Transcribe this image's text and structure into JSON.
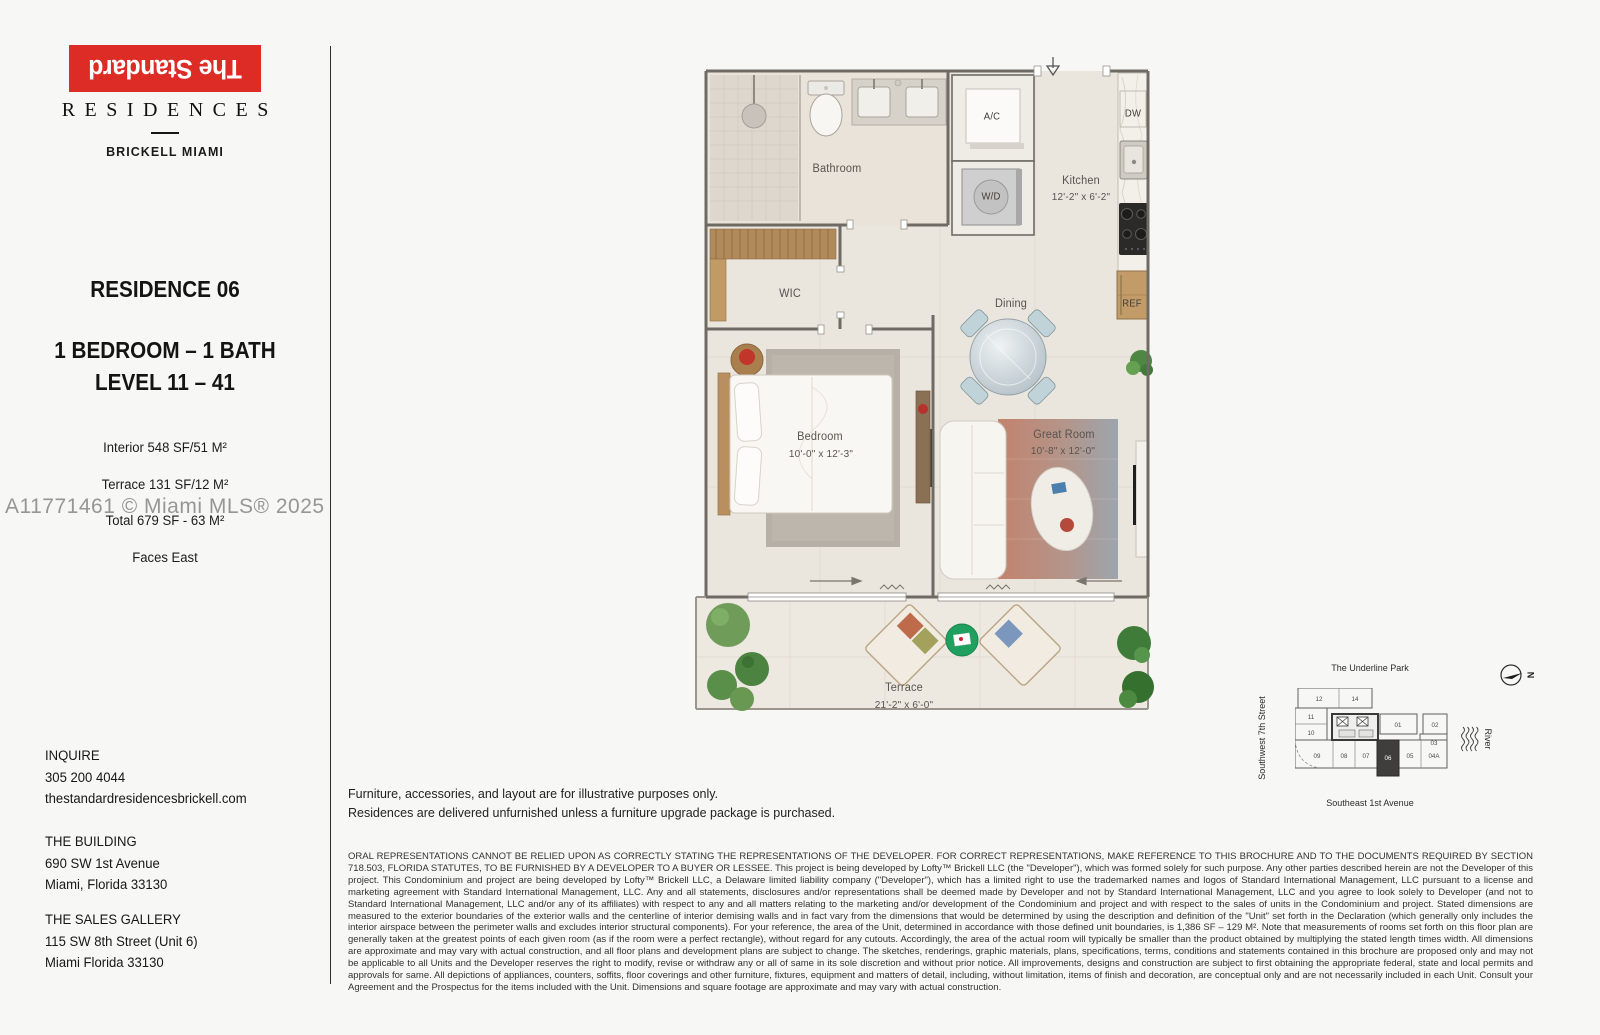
{
  "brand": {
    "logo_text": "The Standard",
    "residences": "RESIDENCES",
    "location": "BRICKELL MIAMI"
  },
  "unit": {
    "title": "RESIDENCE 06",
    "config": "1 BEDROOM – 1 BATH",
    "level": "LEVEL 11 – 41",
    "interior": "Interior 548 SF/51 M²",
    "terrace": "Terrace 131 SF/12 M²",
    "total": "Total 679 SF - 63 M²",
    "faces": "Faces East"
  },
  "watermark": "A11771461 © Miami MLS® 2025",
  "contact": {
    "inquire_label": "INQUIRE",
    "phone": "305 200 4044",
    "website": "thestandardresidencesbrickell.com",
    "building_label": "THE BUILDING",
    "building_address1": "690 SW 1st Avenue",
    "building_address2": "Miami, Florida 33130",
    "gallery_label": "THE SALES GALLERY",
    "gallery_address1": "115 SW 8th Street (Unit 6)",
    "gallery_address2": "Miami Florida 33130"
  },
  "floorplan": {
    "bathroom": "Bathroom",
    "wic": "WIC",
    "ac": "A/C",
    "wd": "W/D",
    "dw": "DW",
    "ref": "REF",
    "kitchen": "Kitchen",
    "kitchen_dims": "12'-2\" x 6'-2\"",
    "dining": "Dining",
    "bedroom": "Bedroom",
    "bedroom_dims": "10'-0\" x 12'-3\"",
    "great_room": "Great Room",
    "great_room_dims": "10'-8\" x 12'-0\"",
    "terrace": "Terrace",
    "terrace_dims": "21'-2\" x 6'-0\""
  },
  "notes": {
    "line1": "Furniture, accessories, and layout are for illustrative purposes only.",
    "line2": "Residences are delivered unfurnished unless a furniture upgrade package is purchased."
  },
  "legal": "ORAL REPRESENTATIONS CANNOT BE RELIED UPON AS CORRECTLY STATING THE REPRESENTATIONS OF THE DEVELOPER. FOR CORRECT REPRESENTATIONS, MAKE REFERENCE TO THIS BROCHURE AND TO THE DOCUMENTS REQUIRED BY SECTION 718.503, FLORIDA STATUTES, TO BE FURNISHED BY A DEVELOPER TO A BUYER OR LESSEE. This project is being developed by Lofty™ Brickell LLC (the \"Developer\"), which was formed solely for such purpose. Any other parties described herein are not the Developer of this project. This Condominium and project are being developed by Lofty™ Brickell LLC, a Delaware limited liability company (\"Developer\"), which has a limited right to use the trademarked names and logos of Standard International Management, LLC pursuant to a license and marketing agreement with Standard International Management, LLC. Any and all statements, disclosures and/or representations shall be deemed made by Developer and not by Standard International Management, LLC and you agree to look solely to Developer (and not to Standard International Management, LLC and/or any of its affiliates) with respect to any and all matters relating to the marketing and/or development of the Condominium and project and with respect to the sales of units in the Condominium and project. Stated dimensions are measured to the exterior boundaries of the exterior walls and the centerline of interior demising walls and in fact vary from the dimensions that would be determined by using the description and definition of the \"Unit\" set forth in the Declaration (which generally only includes the interior airspace between the perimeter walls and excludes interior structural components). For your reference, the area of the Unit, determined in accordance with those defined unit boundaries, is 1,386 SF – 129 M². Note that measurements of rooms set forth on this floor plan are generally taken at the greatest points of each given room (as if the room were a perfect rectangle), without regard for any cutouts. Accordingly, the area of the actual room will typically be smaller than the product obtained by multiplying the stated length times width. All dimensions are approximate and may vary with actual construction, and all floor plans and development plans are subject to change. The sketches, renderings, graphic materials, plans, specifications, terms, conditions and statements contained in this brochure are proposed only and may not be applicable to all Units and the Developer reserves the right to modify, revise or withdraw any or all of same in its sole discretion and without prior notice. All improvements, designs and construction are subject to first obtaining the appropriate federal, state and local permits and approvals for same. All depictions of appliances, counters, soffits, floor coverings and other furniture, fixtures, equipment and matters of detail, including, without limitation, items of finish and decoration, are conceptual only and are not necessarily included in each Unit. Consult your Agreement and the Prospectus for the items included with the Unit. Dimensions and square footage are approximate and may vary with actual construction.",
  "keyplan": {
    "park": "The Underline Park",
    "street_left": "Southwest 7th Street",
    "street_bottom": "Southeast 1st Avenue",
    "river": "River",
    "north": "N",
    "highlighted_unit": "06",
    "units": [
      "12",
      "14",
      "11",
      "10",
      "01",
      "02",
      "03",
      "09",
      "08",
      "07",
      "06",
      "05",
      "04A"
    ]
  },
  "colors": {
    "brand_red": "#dd2b25",
    "floor_beige": "#eae5dd",
    "wall_gray": "#6f6b64",
    "watermark_gray": "#8f8f8f",
    "highlight_dark": "#3f3e3c"
  }
}
